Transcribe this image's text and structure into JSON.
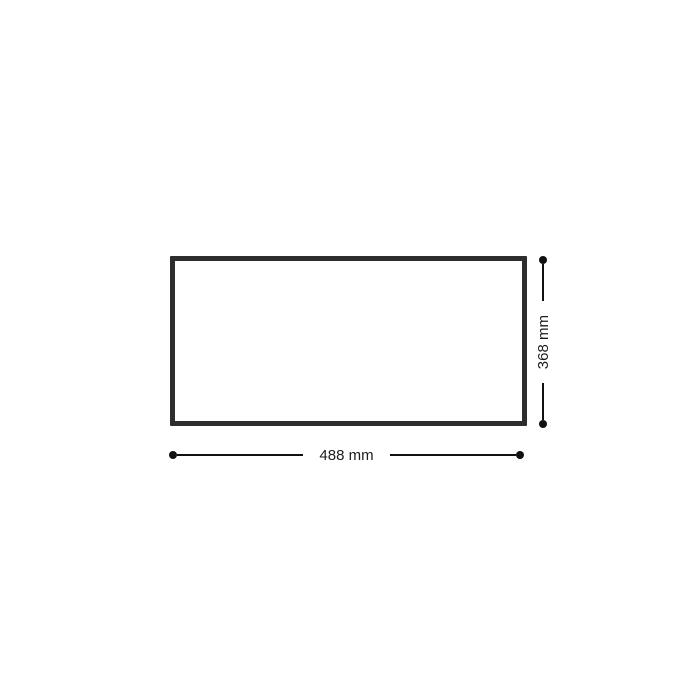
{
  "diagram": {
    "type": "dimension-drawing",
    "shape": "rectangle",
    "width_label": "488 mm",
    "height_label": "368 mm",
    "width_value_mm": 488,
    "height_value_mm": 368,
    "colors": {
      "background": "#ffffff",
      "rectangle_outline": "#2d2d2d",
      "dimension_lines": "#111111",
      "label_text": "#1c1c1c"
    }
  }
}
